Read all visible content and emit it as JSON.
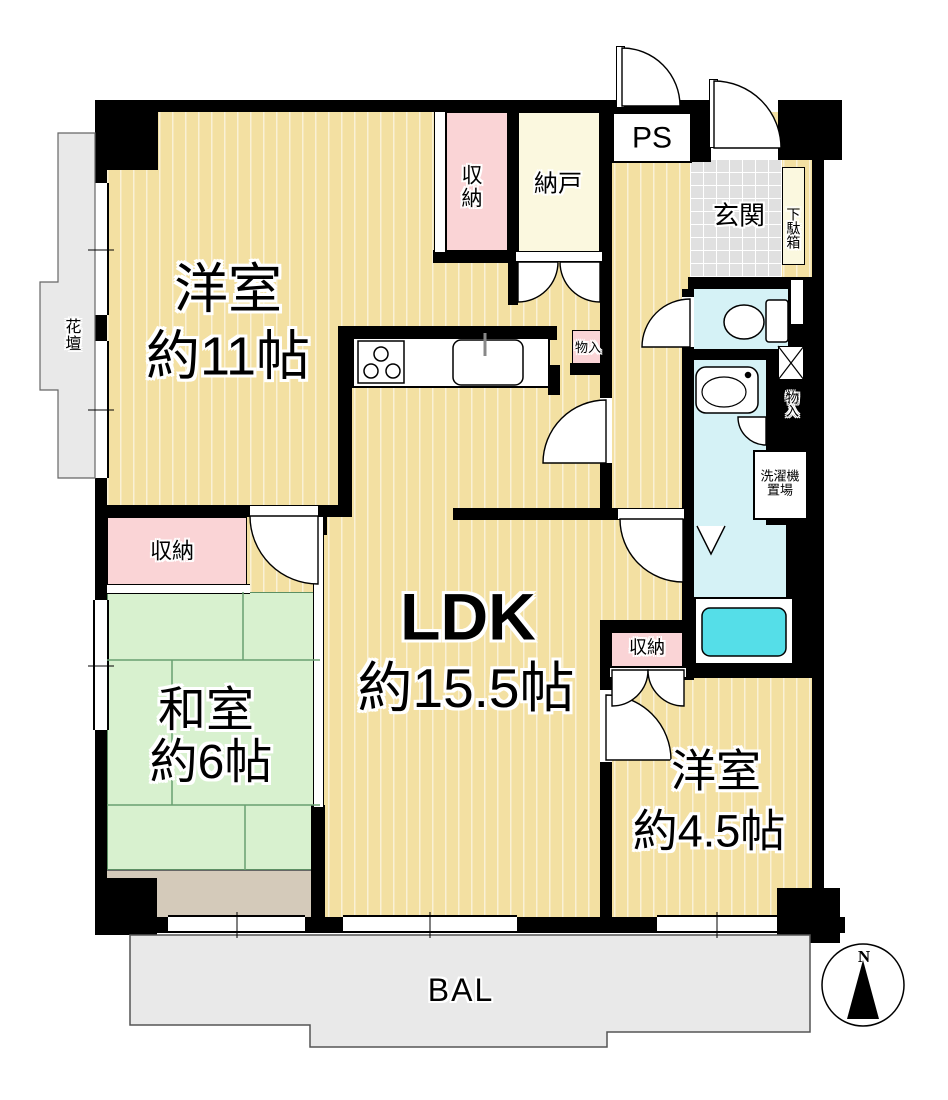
{
  "rooms": {
    "western11": {
      "name": "洋室",
      "size": "約11帖"
    },
    "ldk": {
      "name": "LDK",
      "size": "約15.5帖"
    },
    "japanese6": {
      "name": "和室",
      "size": "約6帖"
    },
    "western45": {
      "name": "洋室",
      "size": "約4.5帖"
    }
  },
  "storage": {
    "closet_top": "収納",
    "nando": "納戸",
    "closet_west": "収納",
    "closet_45": "収納",
    "monoire_kitchen": "物入",
    "monoire_east": "物入"
  },
  "entry": {
    "genkan": "玄関",
    "getabako": "下駄箱",
    "ps": "PS"
  },
  "utility": {
    "laundry_line1": "洗濯機",
    "laundry_line2": "置場"
  },
  "outdoor": {
    "kadan": "花壇",
    "balcony": "BAL"
  },
  "compass": {
    "north": "N"
  },
  "colors": {
    "wall": "#000000",
    "wood_floor": "#F3E0A2",
    "tatami": "#D8F1CF",
    "closet_pink": "#FAD4D6",
    "storage_cream": "#FBF8DF",
    "entry_tile": "#E0E0E0",
    "wet_area": "#D5F2F6",
    "bathtub": "#55DEE8",
    "balcony_gray": "#E9E9E9",
    "wood_strip": "#D4CABA"
  }
}
